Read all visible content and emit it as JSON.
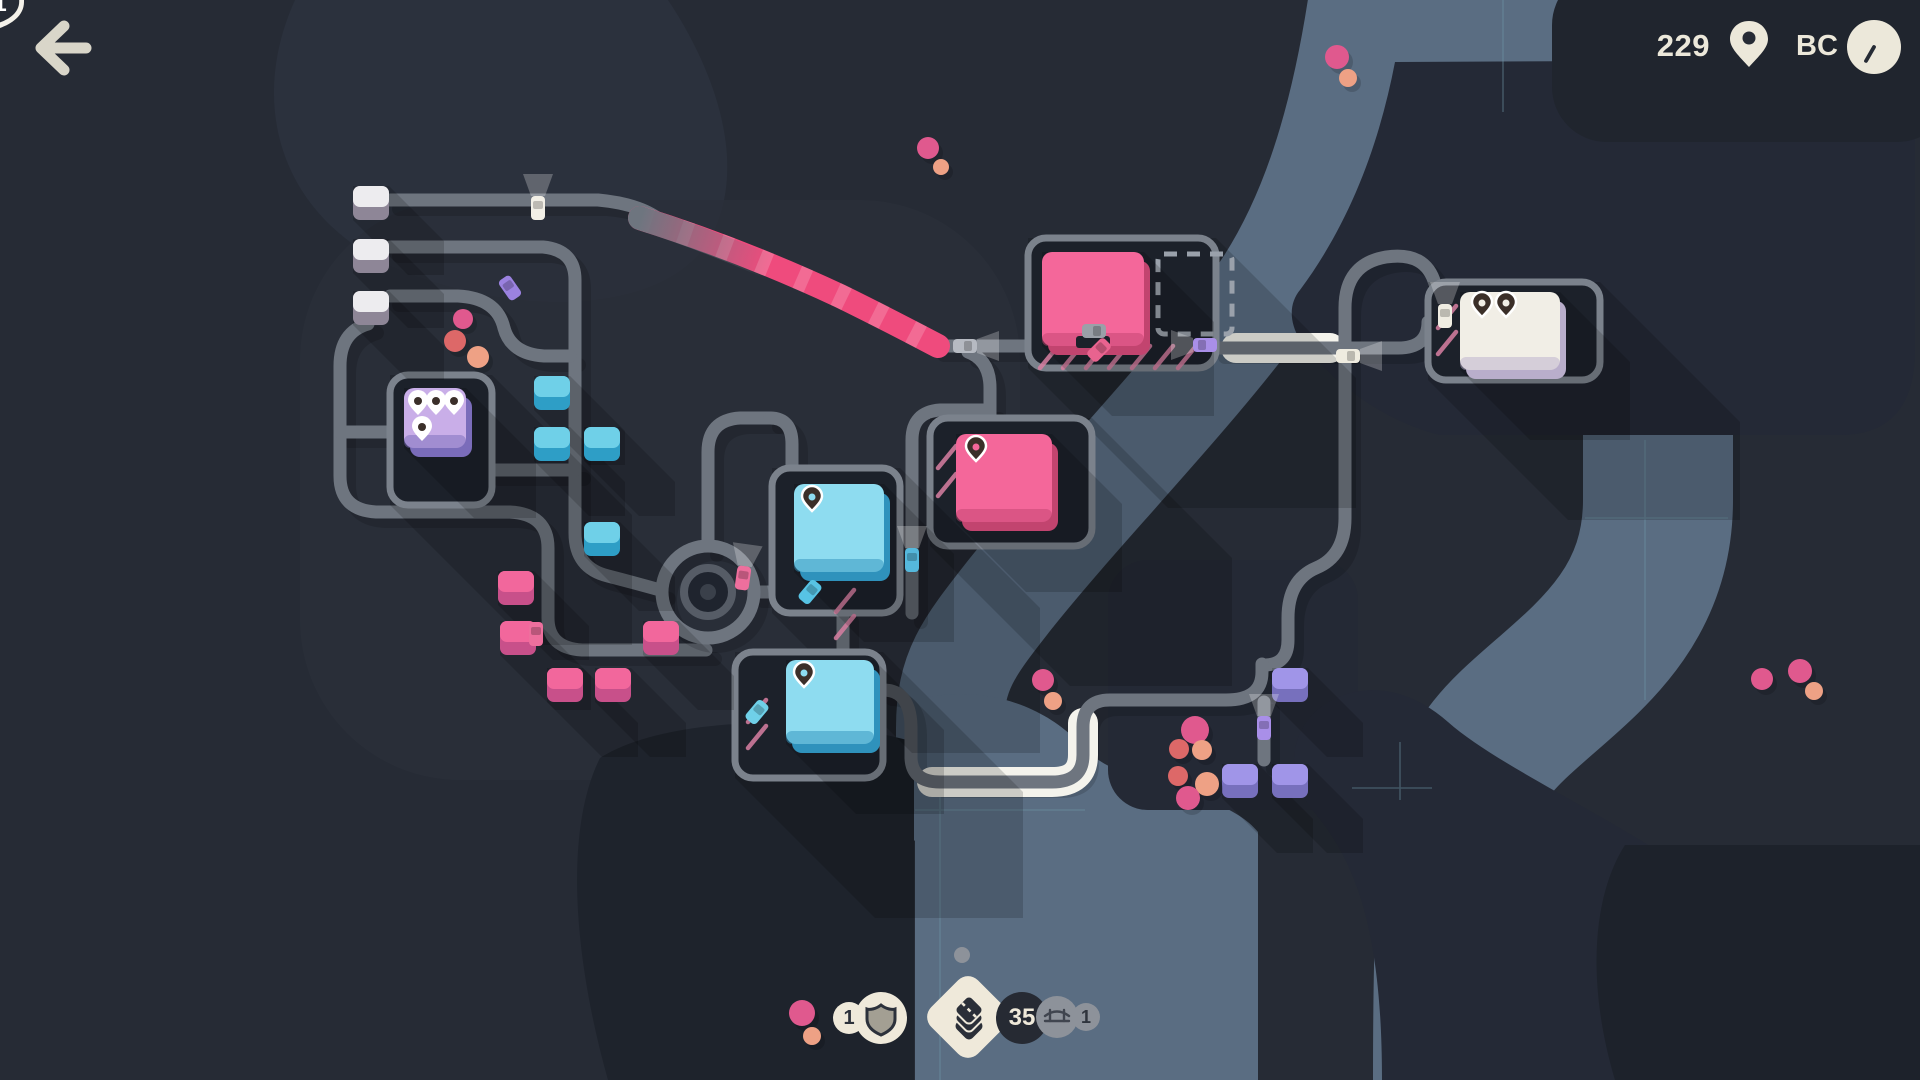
{
  "ui": {
    "score": {
      "value": "229"
    },
    "era": {
      "label": "BC"
    },
    "rewards": {
      "shield": {
        "count": "1"
      },
      "tiles": {
        "count": "35"
      },
      "bridge": {
        "count": "1"
      }
    }
  },
  "map": {
    "motorway": {
      "number": "1",
      "x": 732,
      "y": 272
    },
    "river_labels": [
      {
        "text": "隅田川",
        "x": 1294,
        "y": 212,
        "rot": -58
      },
      {
        "text": "隅田川",
        "x": 1062,
        "y": 607,
        "rot": -58
      },
      {
        "text": "荒川",
        "x": 1653,
        "y": 566,
        "rot": -90
      }
    ],
    "label_color": "#d98ca3",
    "palettes": {
      "gray": [
        "#edecef",
        "#8e8697"
      ],
      "blue": [
        "#6fd0e8",
        "#2e9ec6"
      ],
      "pink": [
        "#f2679c",
        "#c8508a"
      ],
      "purple": [
        "#a095e8",
        "#7770bd"
      ]
    },
    "dot_colors": {
      "p": "#e0598e",
      "r": "#dd6868",
      "s": "#eea185"
    },
    "houses": [
      {
        "x": 353,
        "y": 186,
        "t": "gray"
      },
      {
        "x": 353,
        "y": 239,
        "t": "gray"
      },
      {
        "x": 353,
        "y": 291,
        "t": "gray"
      },
      {
        "x": 534,
        "y": 376,
        "t": "blue"
      },
      {
        "x": 534,
        "y": 427,
        "t": "blue"
      },
      {
        "x": 584,
        "y": 427,
        "t": "blue"
      },
      {
        "x": 584,
        "y": 522,
        "t": "blue"
      },
      {
        "x": 498,
        "y": 571,
        "t": "pink"
      },
      {
        "x": 500,
        "y": 621,
        "t": "pink"
      },
      {
        "x": 643,
        "y": 621,
        "t": "pink"
      },
      {
        "x": 547,
        "y": 668,
        "t": "pink"
      },
      {
        "x": 595,
        "y": 668,
        "t": "pink"
      },
      {
        "x": 1272,
        "y": 668,
        "t": "purple"
      },
      {
        "x": 1222,
        "y": 764,
        "t": "purple"
      },
      {
        "x": 1272,
        "y": 764,
        "t": "purple"
      }
    ],
    "destinations": [
      {
        "lot": [
          390,
          375,
          102,
          130
        ],
        "face": "#c9aee8",
        "base": "#7a6cba",
        "bld": [
          404,
          388,
          62,
          60
        ],
        "pins": [
          [
            418,
            406
          ],
          [
            436,
            406
          ],
          [
            454,
            406
          ],
          [
            422,
            432
          ]
        ],
        "pin_style": "white"
      },
      {
        "lot": [
          1028,
          238,
          188,
          130
        ],
        "face": "#f4679a",
        "base": "#c2446f",
        "bld": [
          1042,
          252,
          102,
          94
        ],
        "pins": [],
        "pin_style": "dark",
        "notch": true,
        "dashed": [
          1158,
          254,
          74,
          80
        ],
        "stripes": {
          "x": 1040,
          "y": 346,
          "n": 7,
          "step": 23,
          "vert": false
        }
      },
      {
        "lot": [
          930,
          418,
          162,
          128
        ],
        "face": "#f4679a",
        "base": "#c2446f",
        "bld": [
          956,
          434,
          96,
          88
        ],
        "pins": [
          [
            976,
            452
          ]
        ],
        "pin_style": "dark",
        "stripes": {
          "x": 938,
          "y": 446,
          "n": 2,
          "step": 28,
          "vert": true
        }
      },
      {
        "lot": [
          772,
          468,
          128,
          145
        ],
        "face": "#8edcf0",
        "base": "#2f92bc",
        "bld": [
          794,
          484,
          90,
          88
        ],
        "pins": [
          [
            812,
            502
          ]
        ],
        "pin_style": "dark",
        "stripes": {
          "x": 836,
          "y": 590,
          "n": 2,
          "step": 26,
          "vert": true
        }
      },
      {
        "lot": [
          735,
          652,
          148,
          126
        ],
        "face": "#8edcf0",
        "base": "#2f92bc",
        "bld": [
          786,
          660,
          88,
          84
        ],
        "pins": [
          [
            804,
            678
          ]
        ],
        "pin_style": "dark",
        "stripes": {
          "x": 748,
          "y": 700,
          "n": 2,
          "step": 26,
          "vert": true
        }
      },
      {
        "lot": [
          1428,
          282,
          172,
          98
        ],
        "face": "#f1eee6",
        "base": "#b9aecb",
        "bld": [
          1460,
          292,
          100,
          78
        ],
        "pins": [
          [
            1482,
            308
          ],
          [
            1506,
            308
          ]
        ],
        "pin_style": "dark",
        "stripes": {
          "x": 1438,
          "y": 306,
          "n": 2,
          "step": 26,
          "vert": true
        }
      }
    ],
    "dots": [
      [
        928,
        148,
        "p",
        11
      ],
      [
        941,
        167,
        "s",
        8
      ],
      [
        1337,
        57,
        "p",
        12
      ],
      [
        1348,
        78,
        "s",
        9
      ],
      [
        463,
        319,
        "p",
        10
      ],
      [
        455,
        341,
        "r",
        11
      ],
      [
        478,
        357,
        "s",
        11
      ],
      [
        1043,
        680,
        "p",
        11
      ],
      [
        1053,
        701,
        "s",
        9
      ],
      [
        1195,
        730,
        "p",
        14
      ],
      [
        1179,
        749,
        "r",
        10
      ],
      [
        1202,
        750,
        "s",
        10
      ],
      [
        1178,
        776,
        "r",
        10
      ],
      [
        1207,
        784,
        "s",
        12
      ],
      [
        1188,
        798,
        "p",
        12
      ],
      [
        1762,
        679,
        "p",
        11
      ],
      [
        1800,
        671,
        "p",
        12
      ],
      [
        1814,
        691,
        "s",
        9
      ],
      [
        802,
        1013,
        "p",
        13
      ],
      [
        812,
        1036,
        "s",
        9
      ]
    ],
    "cars": [
      [
        538,
        208,
        0,
        "#f2efe6",
        1
      ],
      [
        510,
        288,
        -35,
        "#9b82e0",
        0
      ],
      [
        965,
        346,
        90,
        "#b6bac2",
        1
      ],
      [
        1094,
        331,
        90,
        "#9aa0a8",
        0
      ],
      [
        1099,
        350,
        45,
        "#e8638f",
        0
      ],
      [
        1205,
        345,
        -90,
        "#a98fe8",
        1
      ],
      [
        1348,
        356,
        90,
        "#efece0",
        1
      ],
      [
        912,
        560,
        0,
        "#55b8dc",
        1
      ],
      [
        810,
        592,
        40,
        "#57c3e4",
        0
      ],
      [
        757,
        712,
        40,
        "#6fd0e8",
        0
      ],
      [
        743,
        578,
        8,
        "#ee6f9d",
        1
      ],
      [
        536,
        634,
        0,
        "#ee6f9d",
        0
      ],
      [
        1264,
        728,
        0,
        "#a98fe8",
        1
      ],
      [
        1445,
        316,
        0,
        "#f0ede2",
        1
      ]
    ],
    "traffic_lights": [
      [
        516,
        206,
        0
      ],
      [
        658,
        332,
        1
      ],
      [
        650,
        667,
        1
      ],
      [
        705,
        702,
        1
      ],
      [
        1334,
        542,
        1
      ]
    ],
    "colors": {
      "water": "#5a6d82",
      "road": "#6e757f",
      "lot_fill": "#1c212a",
      "lot_border": "#7b828c",
      "motorway": "#ef4b7d",
      "grid_line": "#6f98a8",
      "green_light": "#3fd07c"
    }
  }
}
